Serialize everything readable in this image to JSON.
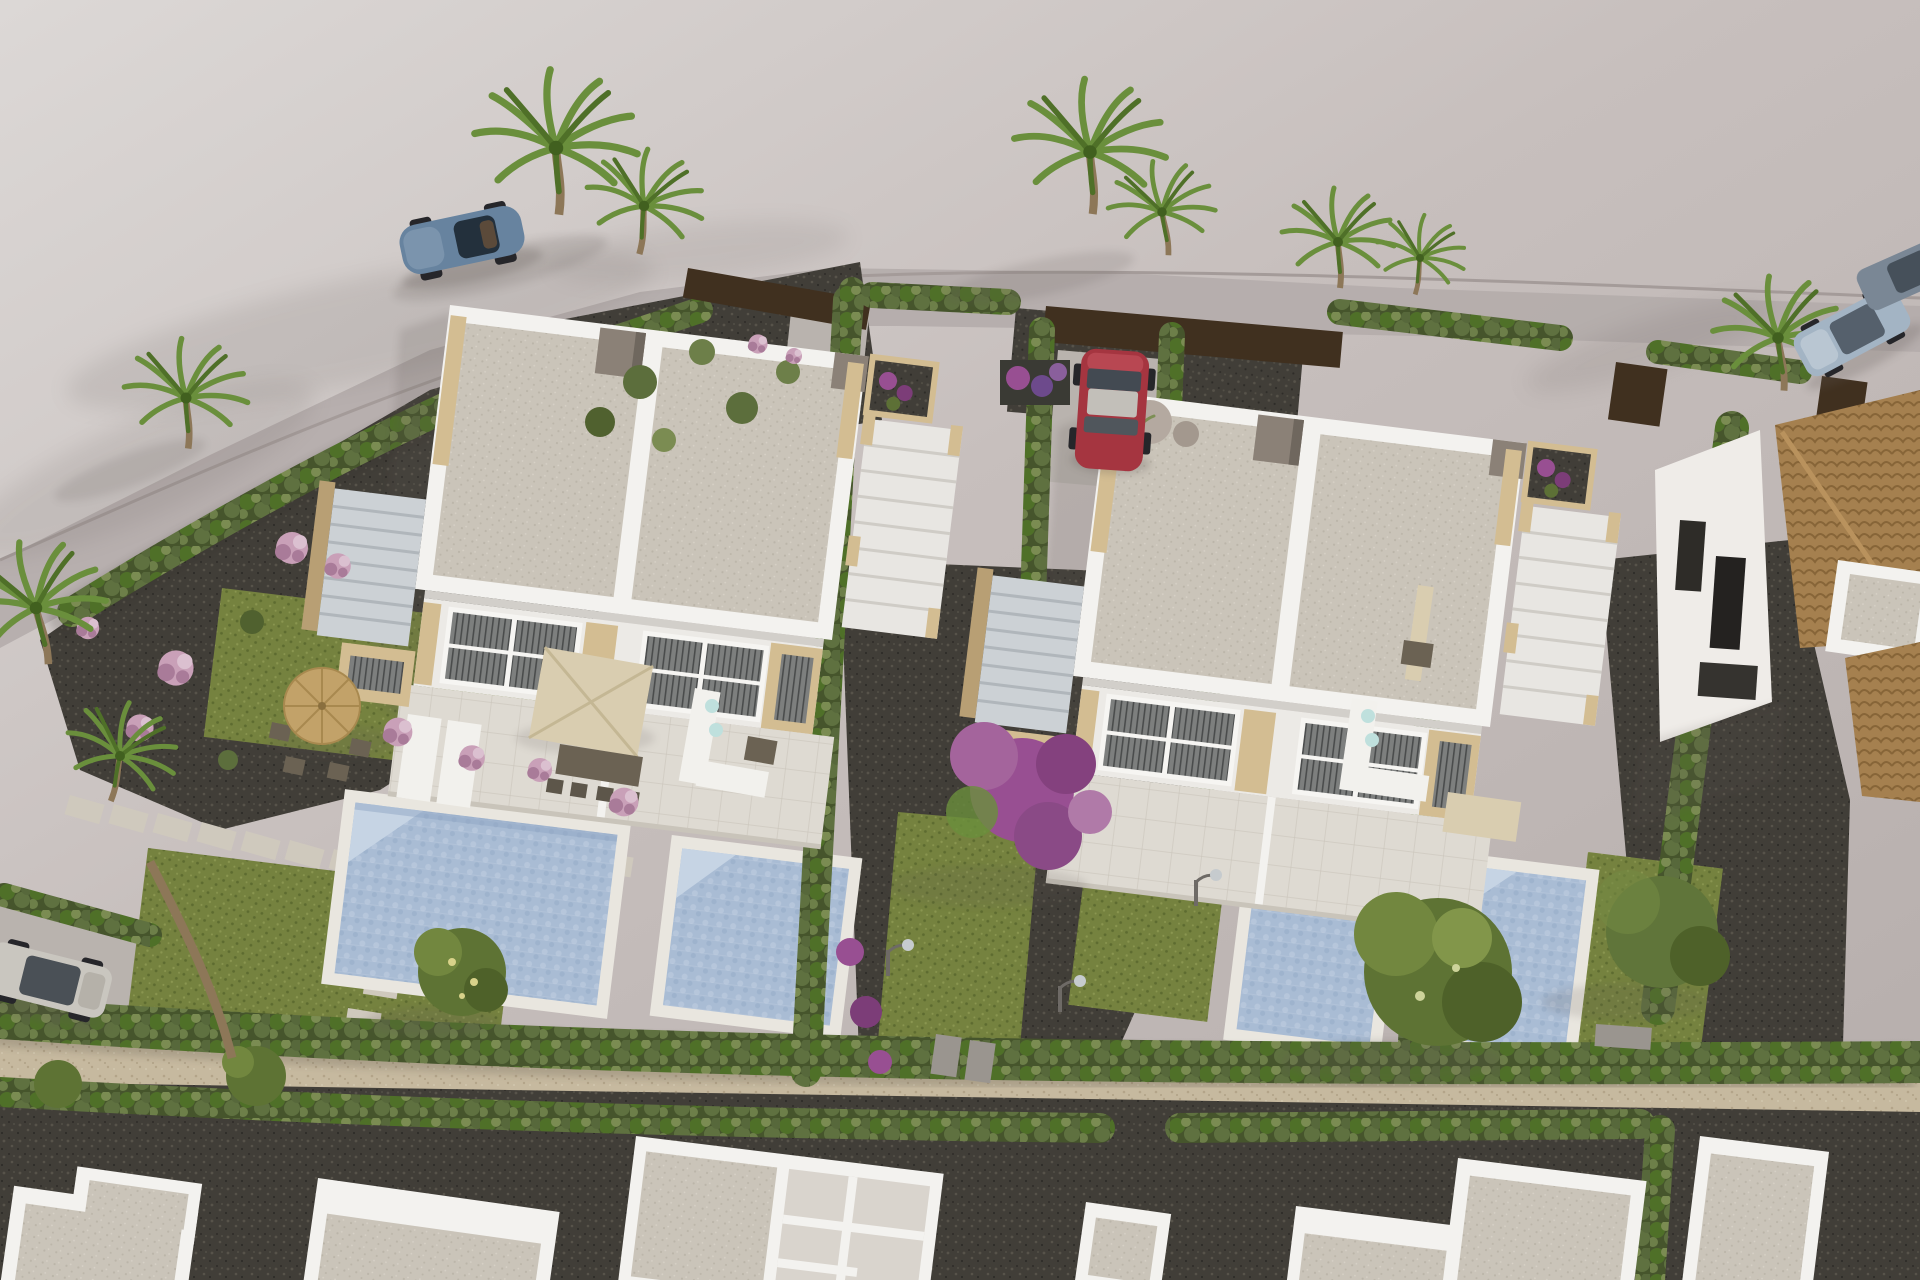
{
  "scene": {
    "aria_label": "Aerial 3D architectural rendering of a new residential development: two modern white duplex villas with flat roofs, travertine stair accents, private pools and landscaped gardens, separated by cypress hedges; a red car parked between them, a blue roadster and silver SUVs on the surrounding street, palm trees, houses under construction along the bottom and a neighboring clay-tile-roof house at the right",
    "setting": "sunny daytime, long soft shadows falling to the lower left",
    "objects": [
      "white duplex villa with roof terrace (left)",
      "white duplex villa with roof terrace (right)",
      "four private swimming pools with light blue water",
      "landscaped corner garden with straw parasol, table and chairs",
      "terraces with beige parasol, dining set, loungers and corner sofas",
      "cypress hedge rows and green lawns",
      "dark gravel planting beds with pink and purple flowering shrubs",
      "bougainvillea tree with purple blossom",
      "stepping stone paths",
      "red hatchback parked in driveway between the villas",
      "blue roadster parked on the street (top left)",
      "silver SUV driving at top right",
      "white SUV parked at bottom left",
      "street lamps",
      "row of houses under construction along the bottom",
      "neighboring house with brown clay tile roof (right edge)",
      "palm trees"
    ],
    "villa_count": 2,
    "pool_count": 4
  },
  "colors": {
    "ground": "#c4bcba",
    "ground_light": "#d8d3d1",
    "road": "#b4acab",
    "curb": "#a49b99",
    "shadow": "#5f5753",
    "dark_gravel": "#413e38",
    "dark_gravel_dot": "#57534a",
    "light_gravel": "#c6b99f",
    "light_gravel_dot": "#b3a489",
    "lawn": "#75823f",
    "lawn_dark": "#5d6b30",
    "lawn_light": "#8a9650",
    "roof": "#cac4b9",
    "roof_dot": "#bbb5a9",
    "parapet": "#f3f2ef",
    "facade": "#eceae6",
    "facade_shade": "#d2cfca",
    "travertine": "#d3bd92",
    "travertine_dark": "#b89f74",
    "steps": "#ccd1d5",
    "steps_line": "#b0b6bb",
    "window": "#7d7f7e",
    "window_dark": "#4a4c4c",
    "frame": "#f6f5f2",
    "pool": "#a9bcd4",
    "pool_light": "#c6d4e4",
    "pool_dark": "#8fa6c4",
    "coping": "#e9e6df",
    "pave": "#dedad2",
    "pave_line": "#c9c4ba",
    "wall_brown": "#40301f",
    "tile": "#a5804f",
    "tile_dark": "#876538",
    "car_red": "#a53540",
    "car_blue": "#67839f",
    "car_silver": "#c9c6bf",
    "car_steel": "#a3b4c4",
    "palm": "#6a8f3c",
    "palm_dark": "#4f7028",
    "trunk": "#8d7758",
    "flower_pink": "#c9a0b8",
    "flower_pink_dark": "#a97b99",
    "flower_purple": "#984f92",
    "straw": "#c2a269",
    "beige_parasol": "#d9cdb0",
    "furn_white": "#f2f1ed",
    "furn_brown": "#6b6253",
    "aqua": "#bfe0dd",
    "lamp": "#c6cbce",
    "sphere": "#b4a9a0",
    "concrete": "#b9b3ae",
    "box_taupe": "#8b8177"
  }
}
